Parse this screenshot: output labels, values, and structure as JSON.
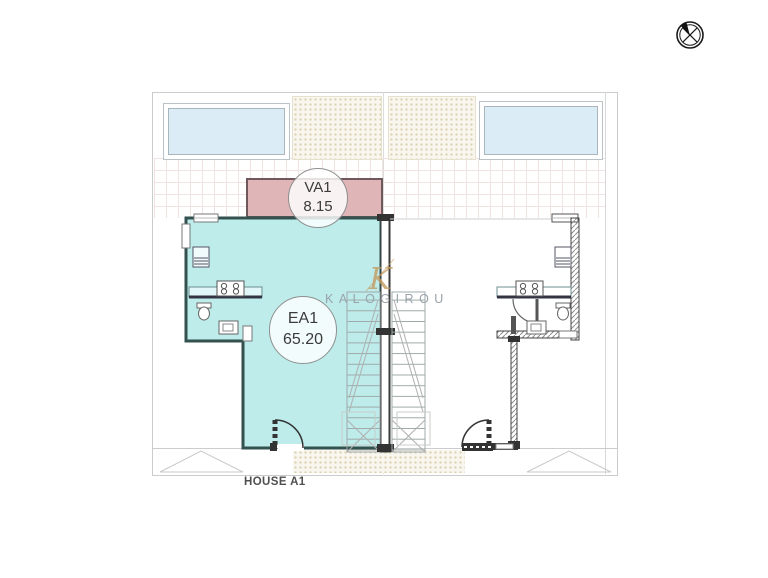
{
  "plan": {
    "title": "HOUSE A1"
  },
  "rooms": {
    "veranda": {
      "code": "VA1",
      "area": "8.15"
    },
    "enclosed": {
      "code": "EA1",
      "area": "65.20"
    }
  },
  "watermark": {
    "brand": "KALOGIROU",
    "monogram": "K"
  },
  "icons": {
    "north_arrow": "compass-north-arrow"
  },
  "colors": {
    "house_fill": "#bdeceb",
    "house_outline": "#33514e",
    "veranda_fill": "#dfb5b7",
    "veranda_outline": "#6e585c",
    "pool_fill": "#dcecf6",
    "wall_dark": "#333333",
    "boundary": "#cccccc",
    "tread": "#9fa8a8",
    "brand_gold": "#c49a5f",
    "brand_gray": "#9aa3ab",
    "label_text": "#3b3b3b",
    "title_text": "#4f4f4f"
  }
}
